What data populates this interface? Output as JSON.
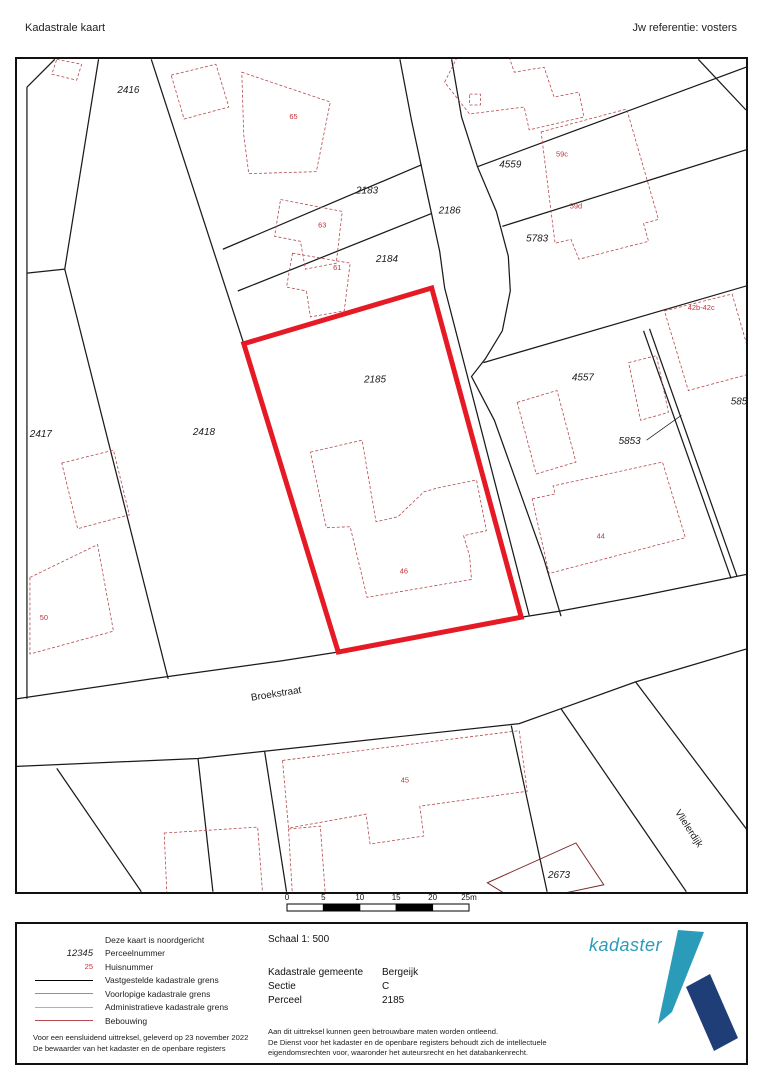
{
  "header": {
    "title": "Kadastrale kaart",
    "reference": "Jw referentie: vosters"
  },
  "map": {
    "colors": {
      "boundary": "#1a1a1a",
      "building": "#b5494d",
      "solid_building": "#7d2b2b",
      "subject": "#e51a25",
      "house_number": "#c4333b",
      "label": "#1a1a1a"
    },
    "subject_parcel": {
      "number": "2185",
      "points": "243,343 432,287 522,618 338,653"
    },
    "boundaries": [
      "53,57 25,85",
      "25,85 25,700",
      "97,57 63,268",
      "25,272 63,268",
      "63,268 167,680",
      "150,57 243,343",
      "222,248 422,163",
      "237,290 432,212",
      "400,57 412,120 427,190 440,250 445,287 530,616",
      "452,57 462,115 478,165 497,210 509,255 511,290 503,330 486,358 472,376 495,420 520,490 545,560 562,617",
      "478,165 748,65",
      "503,225 748,148",
      "484,362 748,285",
      "645,330 733,579",
      "651,328 739,577",
      "15,700 150,680 280,662 338,653",
      "522,618 560,612 640,597 748,575",
      "15,768 197,760 400,738 520,725 562,710 637,683 748,650",
      "562,710 688,894",
      "637,683 750,833",
      "512,727 548,894",
      "197,760 212,894",
      "264,753 286,894",
      "55,770 140,894",
      "700,57 748,108"
    ],
    "buildings": [
      "55,57 80,62 75,78 50,72",
      "170,73 215,62 228,105 183,117",
      "241,70 330,100 316,170 248,172 243,133",
      "280,198 342,210 336,262 305,268 300,240 274,235",
      "292,252 350,262 344,310 310,316 306,290 286,286",
      "445,80 460,50 505,40 515,70 545,65 555,95 580,90 585,115 530,128 525,105 470,112",
      "470,92 481,92 481,103 470,103",
      "542,130 628,107 660,218 645,222 650,240 580,258 572,238 556,242",
      "666,310 734,293 757,372 690,390",
      "630,362 658,355 670,412 642,420",
      "518,402 558,390 577,462 537,474",
      "533,499 556,494 554,486 664,462 687,538 550,574",
      "310,452 362,440 376,522 398,517 424,492 438,488 477,480 487,531 464,536 470,556 472,580 367,598 350,527 326,528",
      "60,463 112,450 128,515 76,529",
      "28,578 96,545 112,632 28,655",
      "163,835 257,829 262,897 166,903",
      "288,831 320,828 325,897 292,899",
      "282,762 520,732 528,793 420,808 424,838 370,846 366,816 288,830"
    ],
    "solid_buildings": [
      "488,885 577,845 605,887 520,905"
    ],
    "leader_lines": [
      {
        "x1": 648,
        "y1": 440,
        "x2": 683,
        "y2": 415
      }
    ],
    "parcel_labels": [
      {
        "t": "2416",
        "x": 127,
        "y": 91
      },
      {
        "t": "2183",
        "x": 367,
        "y": 192
      },
      {
        "t": "2184",
        "x": 387,
        "y": 261
      },
      {
        "t": "2186",
        "x": 450,
        "y": 212
      },
      {
        "t": "4559",
        "x": 511,
        "y": 166
      },
      {
        "t": "5783",
        "x": 538,
        "y": 240
      },
      {
        "t": "2418",
        "x": 203,
        "y": 435
      },
      {
        "t": "2417",
        "x": 39,
        "y": 437
      },
      {
        "t": "2185",
        "x": 375,
        "y": 382
      },
      {
        "t": "4557",
        "x": 584,
        "y": 380
      },
      {
        "t": "5853",
        "x": 631,
        "y": 444
      },
      {
        "t": "585",
        "x": 741,
        "y": 404
      },
      {
        "t": "2673",
        "x": 560,
        "y": 880
      }
    ],
    "house_numbers": [
      {
        "t": "65",
        "x": 293,
        "y": 117
      },
      {
        "t": "63",
        "x": 322,
        "y": 226
      },
      {
        "t": "61",
        "x": 337,
        "y": 269
      },
      {
        "t": "59c",
        "x": 563,
        "y": 155
      },
      {
        "t": "59d",
        "x": 577,
        "y": 207
      },
      {
        "t": "42b-42c",
        "x": 703,
        "y": 309
      },
      {
        "t": "44",
        "x": 602,
        "y": 539
      },
      {
        "t": "46",
        "x": 404,
        "y": 574
      },
      {
        "t": "50",
        "x": 42,
        "y": 621
      },
      {
        "t": "45",
        "x": 405,
        "y": 784
      }
    ],
    "street_labels": [
      {
        "t": "Broekstraat",
        "x": 276,
        "y": 698,
        "r": -9
      },
      {
        "t": "Vlielerdijk",
        "x": 688,
        "y": 832,
        "r": 57
      }
    ]
  },
  "scalebar": {
    "labels": [
      "0",
      "5",
      "10",
      "15",
      "20",
      "25m"
    ]
  },
  "legend": {
    "items": [
      {
        "type": "none",
        "sample": "",
        "label": "Deze kaart is noordgericht"
      },
      {
        "type": "italic",
        "sample": "12345",
        "label": "Perceelnummer"
      },
      {
        "type": "red",
        "sample": "25",
        "label": "Huisnummer"
      },
      {
        "type": "line",
        "color": "#000000",
        "label": "Vastgestelde kadastrale grens"
      },
      {
        "type": "line",
        "color": "#a89a2a",
        "label": "Voorlopige kadastrale grens"
      },
      {
        "type": "line",
        "color": "#55dcc8",
        "label": "Administratieve kadastrale grens"
      },
      {
        "type": "line",
        "color": "#b5494d",
        "label": "Bebouwing"
      }
    ],
    "footnote_line1": "Voor een eensluidend uittreksel, geleverd op 23 november 2022",
    "footnote_line2": "De bewaarder van het kadaster en de openbare registers"
  },
  "details": {
    "schaal": "Schaal 1: 500",
    "rows": [
      {
        "label": "Kadastrale gemeente",
        "value": "Bergeijk"
      },
      {
        "label": "Sectie",
        "value": "C"
      },
      {
        "label": "Perceel",
        "value": "2185"
      }
    ],
    "disclaimer_line1": "Aan dit uittreksel kunnen geen betrouwbare maten worden ontleend.",
    "disclaimer_line2": "De Dienst voor het kadaster en de openbare registers behoudt zich de intellectuele",
    "disclaimer_line3": "eigendomsrechten voor, waaronder het auteursrecht en het databankenrecht."
  },
  "logo": {
    "name": "kadaster",
    "teal": "#2a9cba",
    "navy": "#1f3e78"
  }
}
